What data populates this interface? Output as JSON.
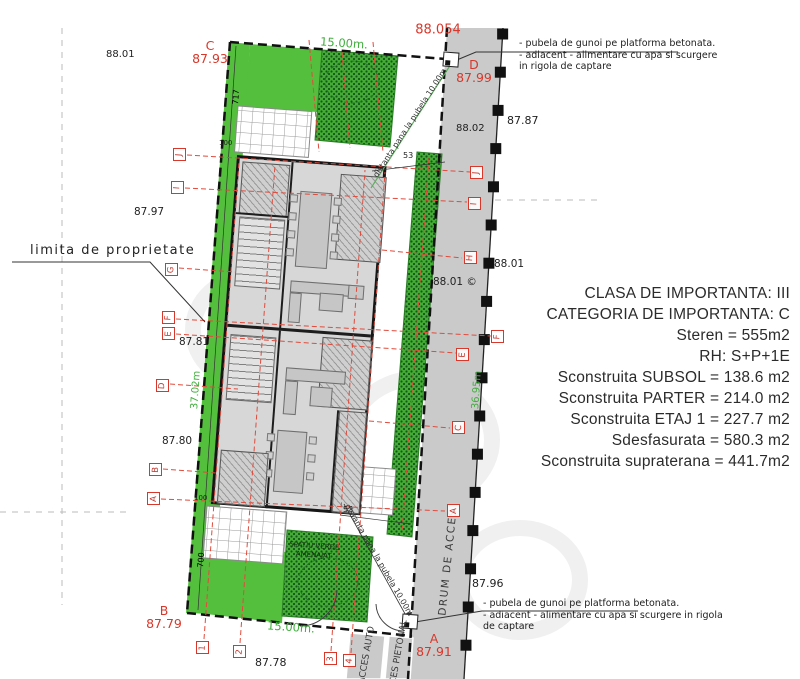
{
  "info_block": {
    "lines": [
      "CLASA DE IMPORTANTA: III",
      "CATEGORIA DE IMPORTANTA: C",
      "Steren = 555m2",
      "RH: S+P+1E",
      "Sconstruita SUBSOL = 138.6 m2",
      "Sconstruita PARTER = 214.0 m2",
      "Sconstruita ETAJ 1 = 227.7 m2",
      "Sdesfasurata = 580.3 m2",
      "Sconstruita supraterana = 441.7m2"
    ]
  },
  "notes": {
    "top": [
      "- pubela de gunoi pe platforma betonata.",
      "- adiacent - alimentare cu apa si scurgere",
      "in rigola de captare"
    ],
    "bottom": [
      "- pubela de gunoi pe platforma betonata.",
      "- adiacent - alimentare cu apa si scurgere in rigola",
      "de captare"
    ]
  },
  "labels": {
    "limita": "limita de proprietate",
    "distanta_top": "distanta pana la pubela 10.00m",
    "distanta_bottom": "distanta pana la pubela 10.00m",
    "drum": "DRUM DE ACCES",
    "acces_auto": "ACCES AUTO",
    "acces_pietonal": "ACCES PIETONAL",
    "spatiu_verde_line1": "SPATIU VERDE",
    "spatiu_verde_line2": "AMENAJAT"
  },
  "elevations": {
    "top_left": "88.01",
    "top_red": "88.054",
    "road_top": "88.02",
    "right_top": "87.87",
    "left_mid": "87.97",
    "right_mid": "88.01",
    "road_mid": "88.01 ©",
    "left_low1": "87.81",
    "left_low2": "87.80",
    "right_low": "87.96",
    "bottom": "87.78"
  },
  "corners": {
    "c": {
      "letter": "C",
      "value": "87.93"
    },
    "d": {
      "letter": "D",
      "value": "87.99"
    },
    "b": {
      "letter": "B",
      "value": "87.79"
    },
    "a": {
      "letter": "A",
      "value": "87.91"
    }
  },
  "dimensions": {
    "top": "15.00m.",
    "bottom": "15.00m.",
    "left_side": "37.02m",
    "right_side": "36.95m",
    "d717": "717",
    "d700": "700",
    "d100a": "100",
    "d100b": "100",
    "d53a": "53",
    "d53b": "53"
  },
  "axes": {
    "left": [
      "J",
      "I",
      "G",
      "F",
      "E",
      "D",
      "B",
      "A"
    ],
    "right": [
      "J",
      "I",
      "H",
      "F",
      "E",
      "C",
      "A"
    ],
    "bottom": [
      "1",
      "2",
      "3",
      "4"
    ]
  },
  "colors": {
    "red_marker": "#d7382b",
    "green_text": "#3fae3c",
    "grass": "#53bf3d",
    "hatch_dot": "#14571a",
    "road": "#cacaca"
  }
}
